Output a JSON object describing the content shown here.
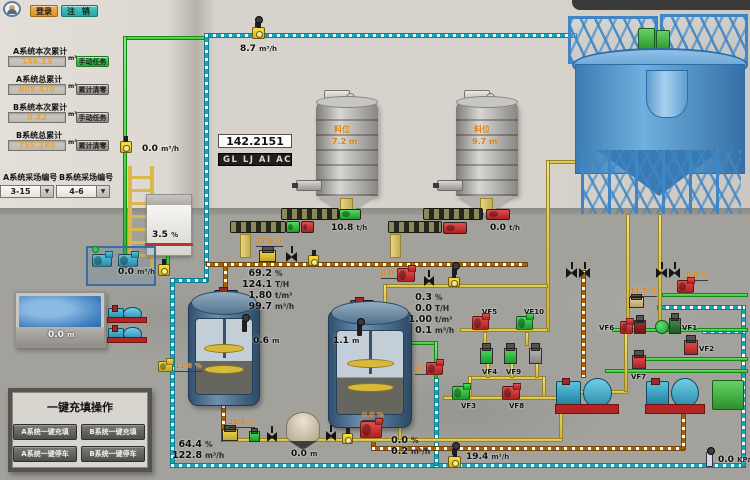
{
  "ui": {
    "login": "登录",
    "logout": "注 销",
    "panel": {
      "title": "一键充填操作",
      "btn_a_fill": "A系统一键充填",
      "btn_b_fill": "B系统一键充填",
      "btn_a_stop": "A系统一键停车",
      "btn_b_stop": "B系统一键停车"
    }
  },
  "totals": {
    "a_current": {
      "label": "A系统本次累计",
      "value": "146.15",
      "unit": "m³",
      "action": "手动任务"
    },
    "a_total": {
      "label": "A系统总累计",
      "value": "808.470",
      "unit": "m³",
      "action": "累计清零"
    },
    "b_current": {
      "label": "B系统本次累计",
      "value": "0.42",
      "unit": "m³",
      "action": "手动任务"
    },
    "b_total": {
      "label": "B系统总累计",
      "value": "765.280",
      "unit": "m³",
      "action": "累计清零"
    }
  },
  "selectors": {
    "a": {
      "label": "A系统采场编号",
      "value": "3-15"
    },
    "b": {
      "label": "B系统采场编号",
      "value": "4-6"
    }
  },
  "display": {
    "value": "142.2151",
    "code": "GL LJ AI ACC"
  },
  "silo1": {
    "name": "料位",
    "level": "7.2",
    "level_unit": "m",
    "rate": "10.8",
    "rate_unit": "t/h"
  },
  "silo2": {
    "name": "料位",
    "level": "9.7",
    "level_unit": "m",
    "rate": "0.0",
    "rate_unit": "t/h"
  },
  "readings": {
    "top_flow": {
      "v": "8.7",
      "u": "m³/h"
    },
    "left_flow": {
      "v": "0.0",
      "u": "m³/h"
    },
    "skid_flow": {
      "v": "0.0",
      "u": "m³/h"
    },
    "tank_conc": {
      "v": "3.5",
      "u": "%"
    },
    "valve_a_open": {
      "v": "17.9",
      "u": "%"
    },
    "pool_level": {
      "v": "0.0",
      "u": "m"
    },
    "pump_valve_open": {
      "v": "11.8",
      "u": "%"
    },
    "tank1_level": {
      "v": "0.6",
      "u": "m"
    },
    "tank2_level": {
      "v": "1.1",
      "u": "m"
    },
    "feed_pump_speed": {
      "v": "0.0",
      "u": "%"
    },
    "tank2_pump_speed": {
      "v": "0.0",
      "u": "%"
    },
    "valve_b_open": {
      "v": "28.8",
      "u": "%"
    },
    "density_b": {
      "v": "64.4",
      "u": "%"
    },
    "flow_b": {
      "v": "122.8",
      "u": "m³/h"
    },
    "hopper_level": {
      "v": "0.0",
      "u": "m"
    },
    "bottom_pump_speed": {
      "v": "0.0",
      "u": "%"
    },
    "drain_pct": {
      "v": "0.0",
      "u": "%"
    },
    "drain_flow": {
      "v": "0.2",
      "u": "m³/h"
    },
    "return_flow": {
      "v": "19.4",
      "u": "m³/h"
    },
    "right_valve_open": {
      "v": "11.5",
      "u": "%"
    },
    "right_pump_speed": {
      "v": "0.0",
      "u": "%"
    },
    "pressure": {
      "v": "0.0",
      "u": "KPa"
    }
  },
  "line_a": {
    "conc": {
      "v": "69.2",
      "u": "%"
    },
    "tph": {
      "v": "124.1",
      "u": "T/H"
    },
    "density": {
      "v": "1.80",
      "u": "t/m³"
    },
    "flow": {
      "v": "99.7",
      "u": "m³/h"
    }
  },
  "line_b": {
    "conc": {
      "v": "0.3",
      "u": "%"
    },
    "tph": {
      "v": "0.0",
      "u": "T/H"
    },
    "density": {
      "v": "1.00",
      "u": "t/m³"
    },
    "flow": {
      "v": "0.1",
      "u": "m³/h"
    }
  },
  "valves": {
    "vf1": "VF1",
    "vf2": "VF2",
    "vf3": "VF3",
    "vf4": "VF4",
    "vf5": "VF5",
    "vf6": "VF6",
    "vf7": "VF7",
    "vf8": "VF8",
    "vf9": "VF9",
    "vf10": "VF10"
  },
  "colors": {
    "accent_orange": "#e8a33d",
    "status_green": "#2fc24d",
    "teal_pipe": "#17a3b8",
    "slurry_pipe": "#a3610a",
    "yellow_pipe": "#e0cc52",
    "green_pipe": "#2ec02e",
    "alarm_red": "#cc2727"
  }
}
